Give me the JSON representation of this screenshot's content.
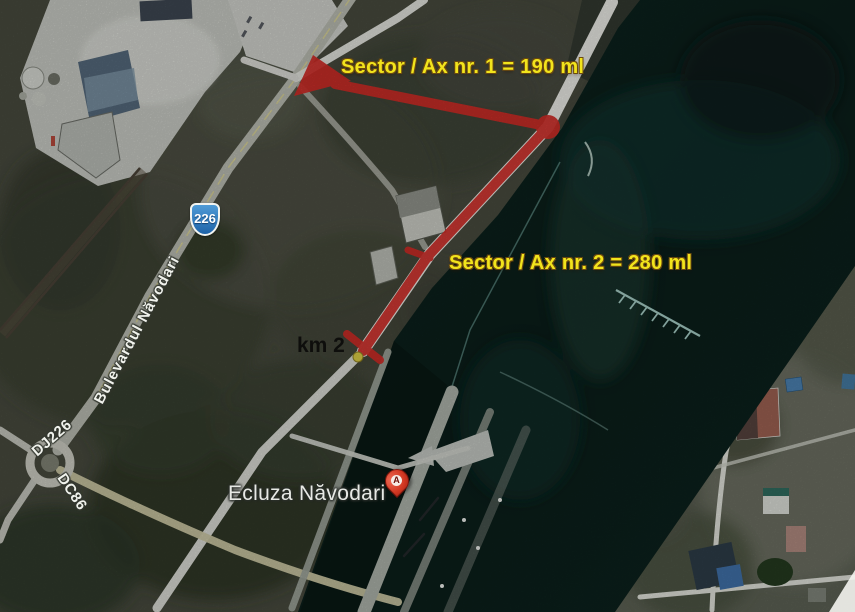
{
  "annotations": {
    "sector1": "Sector / Ax nr. 1 = 190 ml",
    "sector2": "Sector / Ax nr. 2 = 280 ml",
    "km_marker": "km 2"
  },
  "places": {
    "lock": "Ecluza Năvodari",
    "boulevard": "Bulevardul Năvodari",
    "road_dj226": "DJ226",
    "road_dc86": "DC86",
    "shield_226": "226",
    "marker_letter": "A"
  },
  "colors": {
    "route_red": "#ce2b26",
    "annotation_yellow": "#f2e41c",
    "water_dark": "#0a1d19",
    "land_olive": "#46493d",
    "road_light": "#e7e8e2",
    "shield_blue": "#2e7bc0",
    "marker_red": "#d23822"
  }
}
